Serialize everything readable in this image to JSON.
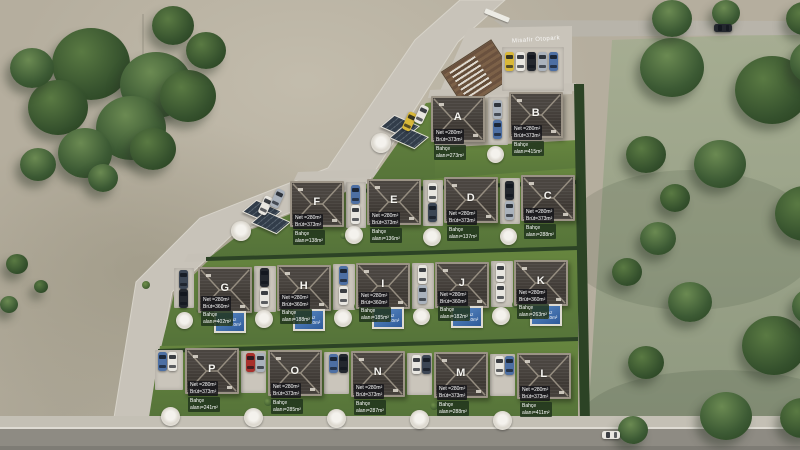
{
  "site": {
    "entrance_text": "Misafir Otopark",
    "pool_line1": "Havuz",
    "pool_line2": "alanı=40m²"
  },
  "houses": [
    {
      "letter": "A",
      "line1": "Net =280m²",
      "line2": "Brüt=373m²",
      "garden1": "Bahçe",
      "garden2": "alanı=273m²",
      "pool": false
    },
    {
      "letter": "B",
      "line1": "Net =280m²",
      "line2": "Brüt=373m²",
      "garden1": "Bahçe",
      "garden2": "alanı=415m²",
      "pool": false
    },
    {
      "letter": "F",
      "line1": "Net =280m²",
      "line2": "Brüt=373m²",
      "garden1": "Bahçe",
      "garden2": "alanı=138m²",
      "pool": false
    },
    {
      "letter": "E",
      "line1": "Net =280m²",
      "line2": "Brüt=373m²",
      "garden1": "Bahçe",
      "garden2": "alanı=136m²",
      "pool": false
    },
    {
      "letter": "D",
      "line1": "Net =280m²",
      "line2": "Brüt=373m²",
      "garden1": "Bahçe",
      "garden2": "alanı=137m²",
      "pool": false
    },
    {
      "letter": "C",
      "line1": "Net =280m²",
      "line2": "Brüt=373m²",
      "garden1": "Bahçe",
      "garden2": "alanı=288m²",
      "pool": false
    },
    {
      "letter": "G",
      "line1": "Net =280m²",
      "line2": "Brüt=360m²",
      "garden1": "Bahçe",
      "garden2": "alanı=402m²",
      "pool": true
    },
    {
      "letter": "H",
      "line1": "Net =280m²",
      "line2": "Brüt=360m²",
      "garden1": "Bahçe",
      "garden2": "alanı=188m²",
      "pool": true
    },
    {
      "letter": "I",
      "line1": "Net =280m²",
      "line2": "Brüt=360m²",
      "garden1": "Bahçe",
      "garden2": "alanı=185m²",
      "pool": true
    },
    {
      "letter": "J",
      "line1": "Net =280m²",
      "line2": "Brüt=360m²",
      "garden1": "Bahçe",
      "garden2": "alanı=182m²",
      "pool": true
    },
    {
      "letter": "K",
      "line1": "Net =280m²",
      "line2": "Brüt=360m²",
      "garden1": "Bahçe",
      "garden2": "alanı=263m²",
      "pool": true
    },
    {
      "letter": "P",
      "line1": "Net =280m²",
      "line2": "Brüt=373m²",
      "garden1": "Bahçe",
      "garden2": "alanı=241m²",
      "pool": false
    },
    {
      "letter": "O",
      "line1": "Net =280m²",
      "line2": "Brüt=373m²",
      "garden1": "Bahçe",
      "garden2": "alanı=285m²",
      "pool": false
    },
    {
      "letter": "N",
      "line1": "Net =280m²",
      "line2": "Brüt=373m²",
      "garden1": "Bahçe",
      "garden2": "alanı=287m²",
      "pool": false
    },
    {
      "letter": "M",
      "line1": "Net =280m²",
      "line2": "Brüt=373m²",
      "garden1": "Bahçe",
      "garden2": "alanı=288m²",
      "pool": false
    },
    {
      "letter": "L",
      "line1": "Net =280m²",
      "line2": "Brüt=373m²",
      "garden1": "Bahçe",
      "garden2": "alanı=411m²",
      "pool": false
    }
  ],
  "car_colors": [
    "#e8e6e0",
    "#3c4654",
    "#aab2bc",
    "#a8302c",
    "#4d6fa3",
    "#d9b838",
    "#23272e"
  ],
  "colors": {
    "lawn": "#5f7f3c",
    "roof": "#3f3a36",
    "pool": "#3b6cab",
    "road": "#c8c3b9",
    "ground": "#b5ae9e",
    "field": "#9aa28b",
    "hedge": "#2c4325"
  }
}
